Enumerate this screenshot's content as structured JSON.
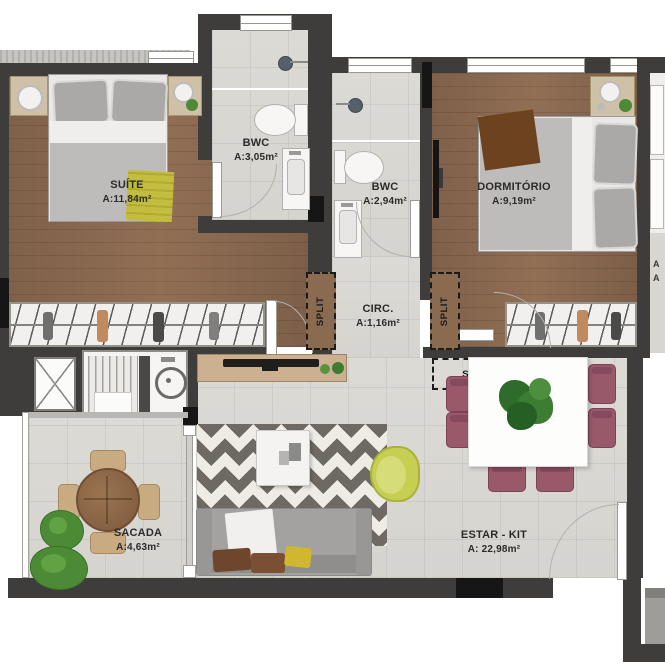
{
  "plan": {
    "rooms": {
      "suite": {
        "name": "SUÍTE",
        "area": "A:11,84m²"
      },
      "bwc_suite": {
        "name": "BWC",
        "area": "A:3,05m²"
      },
      "bwc_social": {
        "name": "BWC",
        "area": "A:2,94m²"
      },
      "dormitorio": {
        "name": "DORMITÓRIO",
        "area": "A:9,19m²"
      },
      "circulacao": {
        "name": "CIRC.",
        "area": "A:1,16m²"
      },
      "sacada": {
        "name": "SACADA",
        "area": "A:4,63m²"
      },
      "estar_kit": {
        "name": "ESTAR - KIT",
        "area": "A: 22,98m²"
      }
    },
    "annotations": {
      "split_suite": "SPLIT",
      "split_dormitorio": "SPLIT",
      "split_estar": "SPLIT",
      "neighbor_partial_1": "A",
      "neighbor_partial_2": "A"
    },
    "colors": {
      "wall": "#3e3d3b",
      "wall_black": "#161616",
      "wood_floor": "#876850",
      "tile_floor": "#dbd9d4",
      "balcony_floor": "#d6d4cf",
      "rug_dark": "#6e6a63",
      "rug_light": "#efece5",
      "dining_chair_plum": "#99596b",
      "armchair_lime": "#c6cf52",
      "sofa_gray": "#a3a2a0",
      "sideboard_wood": "#cbb190",
      "plant_green": "#4c8a36",
      "bed_duvet_gray": "#bdbcba",
      "throw_yellow": "#c3bd3f",
      "throw_brown": "#6d431f"
    }
  }
}
